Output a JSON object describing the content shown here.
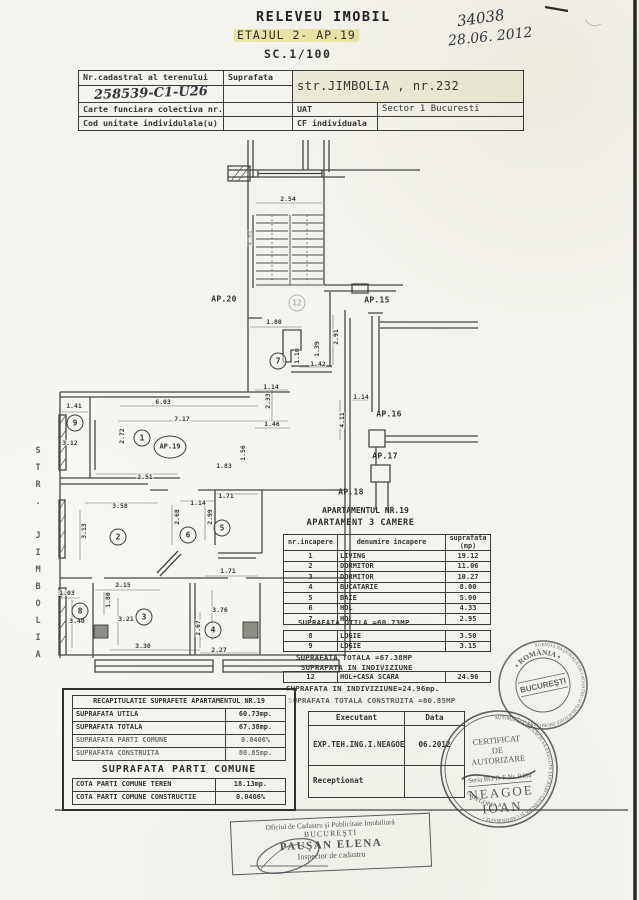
{
  "colors": {
    "paper": "#f4f3ee",
    "ink": "#3a3a3a",
    "highlight": "#ded56e",
    "stamp_ink": "#3d3d44"
  },
  "title": {
    "line1": "RELEVEU IMOBIL",
    "line2": "ETAJUL 2- AP.19",
    "line3": "SC.1/100"
  },
  "annotations": {
    "number": "34038",
    "date": "28.06. 2012",
    "cadastral_number": "258539-C1-U26"
  },
  "header_table": {
    "nr_cadastral": "Nr.cadastral al terenului",
    "suprafata": "Suprafata",
    "address": "str.JIMBOLIA , nr.232",
    "carte_funciara": "Carte funciara colectiva nr.",
    "uat": "UAT",
    "uat_value": "Sector 1 Bucuresti",
    "cod_unitate": "Cod unitate individulala(u)",
    "cf": "CF individuala"
  },
  "plan": {
    "street": "STR. JIMBOLIA",
    "heading1": "APARTAMENTUL NR.19",
    "heading2": "APARTAMENT 3 CAMERE",
    "dims": [
      {
        "t": "2.54",
        "x": 288,
        "y": 199
      },
      {
        "t": "4.01",
        "x": 250,
        "y": 238,
        "v": 1,
        "faint": 1
      },
      {
        "t": "1.80",
        "x": 274,
        "y": 322
      },
      {
        "t": "2.91",
        "x": 336,
        "y": 337,
        "v": 1
      },
      {
        "t": "1.39",
        "x": 317,
        "y": 349,
        "v": 1
      },
      {
        "t": "1.10",
        "x": 297,
        "y": 356,
        "v": 1
      },
      {
        "t": "1.42",
        "x": 318,
        "y": 364
      },
      {
        "t": "1.14",
        "x": 271,
        "y": 387
      },
      {
        "t": "2.33",
        "x": 268,
        "y": 401,
        "v": 1
      },
      {
        "t": "1.46",
        "x": 272,
        "y": 424
      },
      {
        "t": "1.14",
        "x": 361,
        "y": 397
      },
      {
        "t": "4.11",
        "x": 342,
        "y": 420,
        "v": 1
      },
      {
        "t": "6.03",
        "x": 163,
        "y": 402
      },
      {
        "t": "7.17",
        "x": 182,
        "y": 419
      },
      {
        "t": "1.41",
        "x": 74,
        "y": 406
      },
      {
        "t": "3.12",
        "x": 70,
        "y": 443
      },
      {
        "t": "2.72",
        "x": 122,
        "y": 436,
        "v": 1
      },
      {
        "t": "1.56",
        "x": 243,
        "y": 453,
        "v": 1
      },
      {
        "t": "1.83",
        "x": 224,
        "y": 466
      },
      {
        "t": "2.51",
        "x": 145,
        "y": 477
      },
      {
        "t": "3.58",
        "x": 120,
        "y": 506
      },
      {
        "t": "3.13",
        "x": 84,
        "y": 531,
        "v": 1
      },
      {
        "t": "1.14",
        "x": 198,
        "y": 503
      },
      {
        "t": "1.71",
        "x": 226,
        "y": 496
      },
      {
        "t": "2.68",
        "x": 177,
        "y": 517,
        "v": 1
      },
      {
        "t": "2.99",
        "x": 210,
        "y": 517,
        "v": 1
      },
      {
        "t": "1.71",
        "x": 228,
        "y": 571
      },
      {
        "t": "2.15",
        "x": 123,
        "y": 585
      },
      {
        "t": "1.03",
        "x": 67,
        "y": 593
      },
      {
        "t": "1.80",
        "x": 108,
        "y": 600,
        "v": 1
      },
      {
        "t": "3.40",
        "x": 77,
        "y": 621
      },
      {
        "t": "3.21",
        "x": 126,
        "y": 619
      },
      {
        "t": "3.76",
        "x": 220,
        "y": 610
      },
      {
        "t": "2.67",
        "x": 198,
        "y": 628,
        "v": 1
      },
      {
        "t": "3.30",
        "x": 143,
        "y": 646
      },
      {
        "t": "2.27",
        "x": 219,
        "y": 650
      }
    ],
    "rooms": [
      {
        "n": "12",
        "x": 297,
        "y": 303,
        "faint": 1
      },
      {
        "n": "7",
        "x": 278,
        "y": 361
      },
      {
        "n": "9",
        "x": 75,
        "y": 423
      },
      {
        "n": "1",
        "x": 142,
        "y": 438
      },
      {
        "n": "AP.19",
        "x": 170,
        "y": 447,
        "cls": "oval"
      },
      {
        "n": "2",
        "x": 118,
        "y": 537
      },
      {
        "n": "6",
        "x": 188,
        "y": 535
      },
      {
        "n": "5",
        "x": 222,
        "y": 528
      },
      {
        "n": "8",
        "x": 80,
        "y": 611
      },
      {
        "n": "3",
        "x": 144,
        "y": 617
      },
      {
        "n": "4",
        "x": 213,
        "y": 630
      }
    ],
    "units": [
      {
        "t": "AP.20",
        "x": 224,
        "y": 299
      },
      {
        "t": "AP.15",
        "x": 377,
        "y": 300
      },
      {
        "t": "AP.16",
        "x": 389,
        "y": 414
      },
      {
        "t": "AP.17",
        "x": 385,
        "y": 456
      },
      {
        "t": "AP.18",
        "x": 351,
        "y": 492
      }
    ]
  },
  "room_table": {
    "headers": {
      "c1": "nr.incapere",
      "c2": "denumire incapere",
      "c3a": "suprafata",
      "c3b": "(mp)"
    },
    "rows": [
      {
        "nr": "1",
        "den": "LIVING",
        "sup": "19.12"
      },
      {
        "nr": "2",
        "den": "DORMITOR",
        "sup": "11.06"
      },
      {
        "nr": "3",
        "den": "DORMITOR",
        "sup": "10.27"
      },
      {
        "nr": "4",
        "den": "BUCATARIE",
        "sup": "8.00"
      },
      {
        "nr": "5",
        "den": "BAIE",
        "sup": "5.00"
      },
      {
        "nr": "6",
        "den": "HOL",
        "sup": "4.33"
      },
      {
        "nr": "7",
        "den": "HOL",
        "sup": "2.95"
      }
    ],
    "utila": "SUPRAFATA UTILA =60.73MP",
    "logii": [
      {
        "nr": "8",
        "den": "LOGIE",
        "sup": "3.50"
      },
      {
        "nr": "9",
        "den": "LOGIE",
        "sup": "3.15"
      }
    ],
    "totala": "SUPRAFATA TOTALA =67.38MP",
    "indiv_title": "SUPRAFATA IN INDIVIZIUNE",
    "indiv_rows": [
      {
        "nr": "12",
        "den": "HOL+CASA SCARA",
        "sup": "24.96"
      }
    ],
    "indiv_note": "SUPRAFATA IN INDIVIZIUNE=24.96mp.",
    "construita": "SUPRAFATA TOTALA CONSTRUITA =80.85MP"
  },
  "recap": {
    "header": "RECAPITULATIE SUPRAFETE APARTAMENTUL NR.19",
    "rows": [
      {
        "l": "SUPRAFATA UTILA",
        "v": "60.73mp."
      },
      {
        "l": "SUPRAFATA TOTALA",
        "v": "67.38mp."
      },
      {
        "l": "SUPRAFATA PARTI COMUNE",
        "v": "0.0406%",
        "ft": 1
      },
      {
        "l": "SUPRAFATA CONSTRUITA",
        "v": "80.85mp.",
        "ft": 1
      }
    ],
    "subtitle": "SUPRAFATA PARTI COMUNE",
    "rows2": [
      {
        "l": "COTA PARTI COMUNE TEREN",
        "v": "18.13mp."
      },
      {
        "l": "COTA PARTI COMUNE CONSTRUCTIE",
        "v": "0.0406%"
      }
    ]
  },
  "executant": {
    "h1": "Executant",
    "h2": "Data",
    "name": "EXP.TEH.ING.I.NEAGOE",
    "date": "06.2012",
    "receipt": "Receptionat"
  },
  "stamps": {
    "ancpi": {
      "country": "• ROMÂNIA •",
      "ring": "AGENŢIA NAŢIONALĂ DE CADASTRU ŞI PUBLICITATE IMOBILIARĂ •",
      "city": "BUCUREŞTI"
    },
    "cert": {
      "l1": "CERTIFICAT",
      "l2": "DE",
      "l3": "AUTORIZARE",
      "serial": "Seria RO-B-F Nr. 0484",
      "name1": "NEAGOE",
      "name2": "IOAN",
      "category": "CATEGORIA A",
      "ring": "AUTORIZATĂ DE ANCPI SĂ EXECUTE LUCRĂRI • GEODEZIE ŞI CARTOGRAFIE •"
    },
    "ocpi": {
      "l1": "Oficiul de Cadastru şi Publicitate Imobiliară",
      "l2": "BUCUREŞTI",
      "l3": "PAUŞAN ELENA",
      "l4": "Inspector de cadastru"
    }
  }
}
